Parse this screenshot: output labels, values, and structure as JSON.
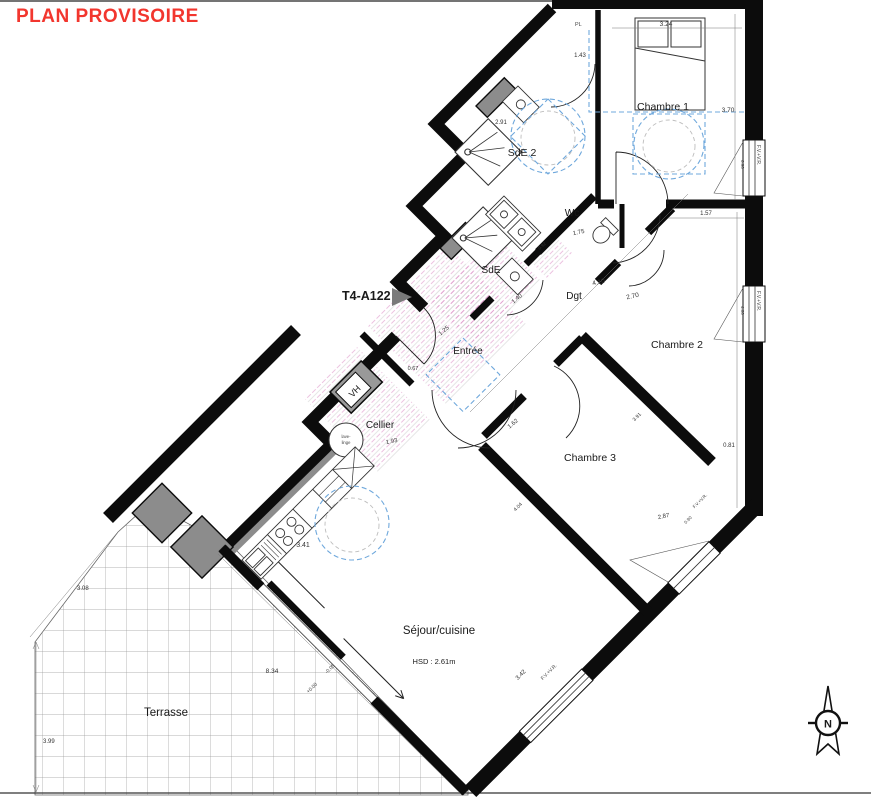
{
  "title": "PLAN PROVISOIRE",
  "unit_id": "T4-A122",
  "rooms": {
    "chambre1": "Chambre 1",
    "sde2": "SdE 2",
    "wc": "Wc",
    "sde": "SdE",
    "dgt": "Dgt",
    "chambre2": "Chambre 2",
    "chambre3": "Chambre 3",
    "entree": "Entrée",
    "cellier": "Cellier",
    "sejour": "Séjour/cuisine",
    "terrasse": "Terrasse"
  },
  "notes": {
    "sejour_height": "HSD : 2.61m",
    "closet": "PL",
    "vent": "VH",
    "north": "N",
    "window_label": "F.V.+V.R.",
    "appliance_line1": "lave-",
    "appliance_line2": "linge"
  },
  "levels": {
    "l1": "+0.00",
    "l2": "-0.05"
  },
  "dims": {
    "d324": "3.24",
    "d143": "1.43",
    "d370": "3.70",
    "d291": "2.91",
    "d175": "1.75",
    "d157": "1.57",
    "d092": "0.92",
    "d140": "1.40",
    "d410": "4.10",
    "d270": "2.70",
    "d125": "1.25",
    "d067": "0.67",
    "d193": "1.93",
    "d341": "3.41",
    "d081": "0.81",
    "d162": "1.62",
    "d287": "2.87",
    "d391": "3.91",
    "d404": "4.04",
    "d834": "8.34",
    "d342": "3.42",
    "d308": "3.08",
    "d399": "3.99",
    "d090": "0.90",
    "d460": "4.60"
  },
  "colors": {
    "title_red": "#f2362e",
    "wall_black": "#0c0c0c",
    "accessibility_blue": "#6fa8dc",
    "tile_pink": "#d77fc0",
    "duct_gray": "#8c8c8c"
  }
}
